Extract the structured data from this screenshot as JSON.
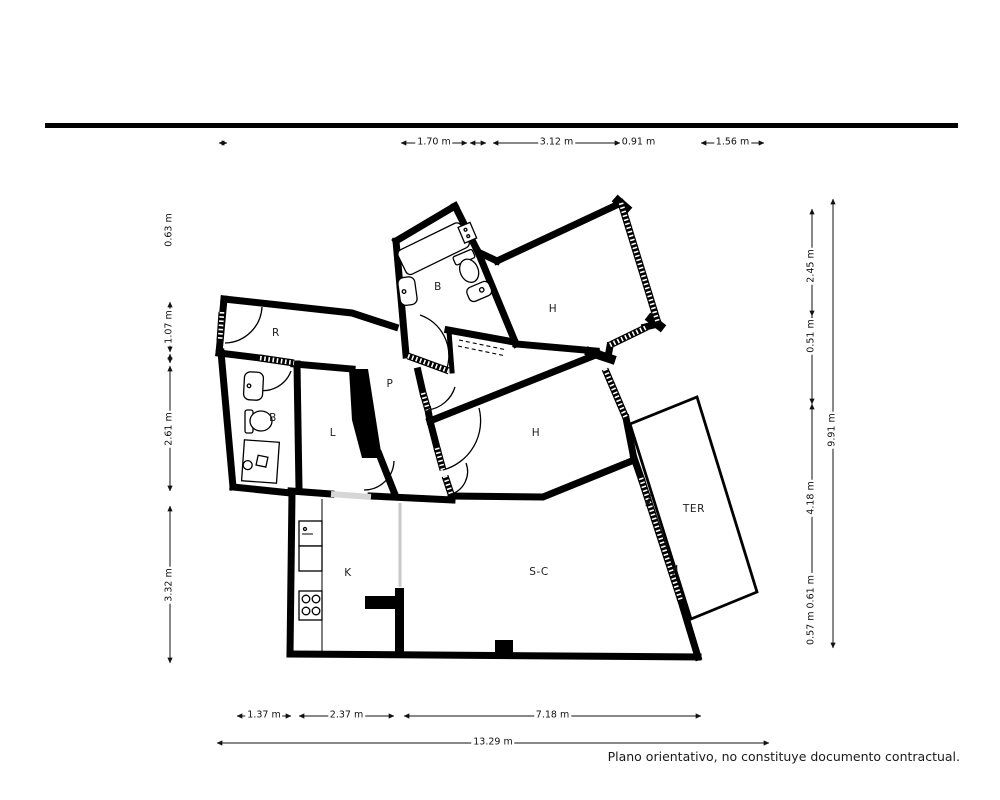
{
  "page": {
    "background": "#ffffff"
  },
  "top_rule": {
    "color": "#000000"
  },
  "footer": {
    "disclaimer": "Plano orientativo, no constituye documento contractual."
  },
  "plan": {
    "wall_color": "#000000",
    "rooms": [
      {
        "name": "bathroom-top",
        "label": "B",
        "x": 438,
        "y": 287
      },
      {
        "name": "bedroom-top-right",
        "label": "H",
        "x": 553,
        "y": 309
      },
      {
        "name": "entry-hall",
        "label": "R",
        "x": 276,
        "y": 333
      },
      {
        "name": "bathroom-left",
        "label": "B",
        "x": 273,
        "y": 418
      },
      {
        "name": "corridor",
        "label": "P",
        "x": 390,
        "y": 384
      },
      {
        "name": "laundry",
        "label": "L",
        "x": 333,
        "y": 433
      },
      {
        "name": "bedroom-middle",
        "label": "H",
        "x": 536,
        "y": 433
      },
      {
        "name": "terrace",
        "label": "TER",
        "x": 694,
        "y": 509
      },
      {
        "name": "kitchen",
        "label": "K",
        "x": 348,
        "y": 573
      },
      {
        "name": "living-dining",
        "label": "S-C",
        "x": 539,
        "y": 572
      }
    ]
  },
  "dimensions": {
    "top": {
      "y": 143,
      "items": [
        {
          "label": "",
          "x1": 219,
          "x2": 227
        },
        {
          "label": "1.70 m",
          "x1": 401,
          "x2": 467
        },
        {
          "label": "",
          "x1": 470,
          "x2": 486
        },
        {
          "label": "3.12 m",
          "x1": 493,
          "x2": 620
        },
        {
          "label": "0.91 m",
          "x1": 622,
          "x2": 655
        },
        {
          "label": "1.56 m",
          "x1": 701,
          "x2": 764
        }
      ]
    },
    "bottom": [
      {
        "y": 716,
        "items": [
          {
            "label": "1.37 m",
            "x1": 237,
            "x2": 291
          },
          {
            "label": "2.37 m",
            "x1": 299,
            "x2": 394
          },
          {
            "label": "7.18 m",
            "x1": 404,
            "x2": 701
          }
        ]
      },
      {
        "y": 743,
        "items": [
          {
            "label": "13.29 m",
            "x1": 217,
            "x2": 769
          }
        ]
      }
    ],
    "left": {
      "x": 170,
      "items": [
        {
          "label": "0.63 m",
          "y1": 206,
          "y2": 254,
          "line": false
        },
        {
          "label": "1.07 m",
          "y1": 302,
          "y2": 352
        },
        {
          "label": "",
          "y1": 354,
          "y2": 363
        },
        {
          "label": "2.61 m",
          "y1": 366,
          "y2": 491
        },
        {
          "label": "3.32 m",
          "y1": 506,
          "y2": 663
        }
      ]
    },
    "right_inner": {
      "x": 812,
      "items": [
        {
          "label": "2.45 m",
          "y1": 209,
          "y2": 316,
          "cy": 266
        },
        {
          "label": "0.51 m",
          "y1": 316,
          "y2": 340,
          "cy": 336
        },
        {
          "label": "",
          "y1": 340,
          "y2": 404
        },
        {
          "label": "4.18 m",
          "y1": 404,
          "y2": 588,
          "cy": 498
        },
        {
          "label": "0.57 m 0.61 m",
          "y1": 588,
          "y2": 641,
          "cy": 610
        }
      ]
    },
    "right_outer": {
      "x": 833,
      "label": "9.91 m",
      "y1": 199,
      "y2": 648,
      "cy": 430
    }
  }
}
